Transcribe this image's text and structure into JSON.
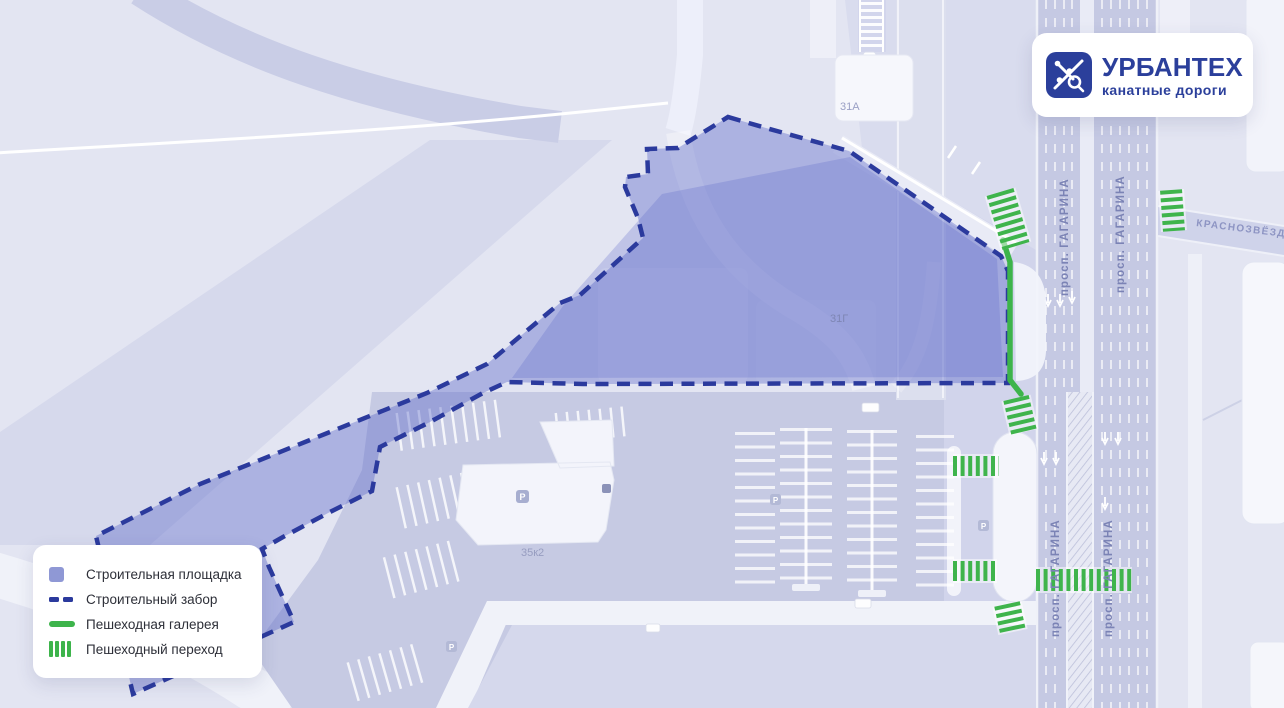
{
  "map": {
    "streets": {
      "gagarina": "просп. ГАГАРИНА",
      "krasnozvezdnaya": "КРАСНОЗВЁЗДНАЯ У"
    },
    "buildings": {
      "b31a": "31А",
      "b31g": "31Г",
      "b35k2": "35к2"
    },
    "parking_badge": "P"
  },
  "legend": {
    "items": [
      {
        "label": "Строительная площадка",
        "swatch": "construction-area"
      },
      {
        "label": "Строительный забор",
        "swatch": "construction-fence"
      },
      {
        "label": "Пешеходная галерея",
        "swatch": "pedestrian-gallery"
      },
      {
        "label": "Пешеходный переход",
        "swatch": "pedestrian-crossing"
      }
    ]
  },
  "logo": {
    "title": "УРБАНТЕХ",
    "subtitle": "канатные дороги"
  },
  "colors": {
    "background": "#E3E5F2",
    "road": "#C5C9E3",
    "construction_fill": "#8F98D5",
    "fence_navy": "#2B3A9D",
    "gallery_green": "#3DB44B",
    "brand_navy": "#2B3F9B"
  }
}
